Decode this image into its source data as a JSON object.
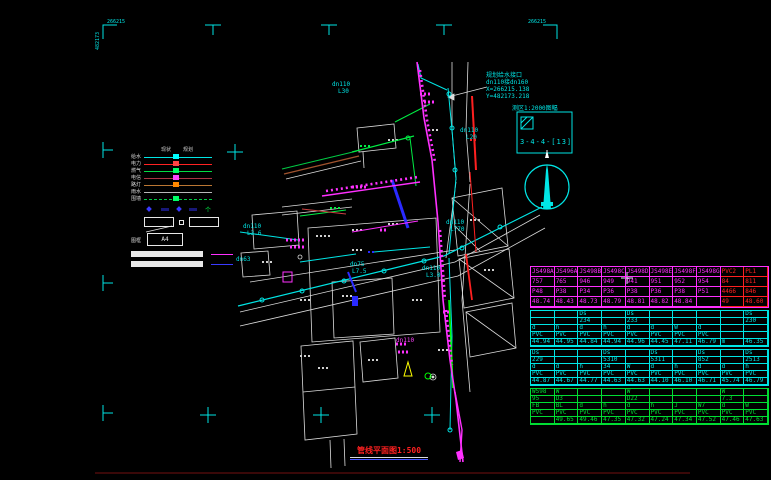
{
  "frame": {
    "corner_label_top_left": "266215",
    "corner_label_side": "482173",
    "corner_label_top_right": "266215"
  },
  "legend": {
    "header": [
      "现状",
      "规划"
    ],
    "lines": [
      {
        "label": "给水",
        "color": "#00e5e5",
        "marker": "#00ffff",
        "style": "solid"
      },
      {
        "label": "电力",
        "color": "#ff2222",
        "marker": "#ff4444",
        "style": "solid"
      },
      {
        "label": "燃气",
        "color": "#00dd44",
        "marker": "#00ff66",
        "style": "solid"
      },
      {
        "label": "电信",
        "color": "#aa3344",
        "marker": "#ff44ff",
        "style": "solid"
      },
      {
        "label": "路灯",
        "color": "#bb7733",
        "marker": "#ff8800",
        "style": "solid"
      },
      {
        "label": "雨水",
        "color": "#b8b8b8",
        "marker": "",
        "style": "solid"
      },
      {
        "label": "围墙",
        "color": "#00cc44",
        "marker": "#00ff66",
        "style": "dashed"
      }
    ],
    "box_label": "图框",
    "a4_label": "A4"
  },
  "annotation": {
    "lines": [
      "规划给水接口",
      "dn110接dn160",
      "X=266215.138",
      "Y=482173.218"
    ]
  },
  "index_box": {
    "header": "测区1:2000图幅",
    "label": "3-4-4-[13]"
  },
  "map_labels": [
    {
      "text": "dn110",
      "x": 332,
      "y": 82
    },
    {
      "text": "L30",
      "x": 338,
      "y": 89
    },
    {
      "text": "dn110",
      "x": 460,
      "y": 128
    },
    {
      "text": "L20",
      "x": 466,
      "y": 135
    },
    {
      "text": "dn110",
      "x": 243,
      "y": 224
    },
    {
      "text": "L3.6",
      "x": 247,
      "y": 231
    },
    {
      "text": "dn110",
      "x": 446,
      "y": 220
    },
    {
      "text": "L770",
      "x": 450,
      "y": 227
    },
    {
      "text": "dn75",
      "x": 350,
      "y": 262
    },
    {
      "text": "L7.5",
      "x": 352,
      "y": 269
    },
    {
      "text": "dn110",
      "x": 422,
      "y": 266
    },
    {
      "text": "L3.0",
      "x": 426,
      "y": 273
    },
    {
      "text": "dn63",
      "x": 236,
      "y": 257
    },
    {
      "text": "dn110",
      "x": 396,
      "y": 338,
      "color": "#ff40ff"
    }
  ],
  "title": {
    "text": "管线平面图1:500"
  },
  "table": {
    "bands": [
      {
        "color": "#ff30ff",
        "alt_color": "#ff2020",
        "alt_from": 8,
        "row_h": 10,
        "rows": [
          [
            "JS498A",
            "JS496A",
            "JS498B",
            "JS498C",
            "JS498D",
            "JS498E",
            "JS498F",
            "JS498G",
            "PVC2",
            "PL1"
          ],
          [
            "757",
            "765",
            "946",
            "949",
            "941",
            "951",
            "952",
            "954",
            "84",
            "811"
          ],
          [
            "P48",
            "P38",
            "P34",
            "P36",
            "P38",
            "P36",
            "P38",
            "P51",
            "4466",
            "846"
          ],
          [
            "48.74",
            "48.43",
            "48.73",
            "48.79",
            "48.81",
            "48.82",
            "48.84",
            "",
            "49",
            "48.60"
          ]
        ]
      },
      {
        "color": "#00e5e5",
        "row_h": 7,
        "rows": [
          [
            "",
            "",
            "Ds",
            "",
            "Ds",
            "",
            "",
            "",
            "",
            "Ds"
          ],
          [
            "",
            "",
            "234",
            "",
            "233",
            "",
            "",
            "",
            "",
            "230"
          ],
          [
            "d",
            "h",
            "d",
            "h",
            "d",
            "d",
            "W",
            "d",
            "",
            ""
          ],
          [
            "PVC",
            "PVC",
            "PVC",
            "PVC",
            "PVC",
            "PVC",
            "PVC",
            "PVC",
            "",
            ""
          ],
          [
            "44.94",
            "44.95",
            "44.84",
            "44.94",
            "44.96",
            "44.45",
            "47.11",
            "46.79",
            "m",
            "46.35"
          ]
        ]
      },
      {
        "color": "#00e5e5",
        "row_h": 7,
        "rows": [
          [
            "Ds",
            "",
            "",
            "Ds",
            "",
            "Ds",
            "",
            "Ds",
            "",
            "Ds"
          ],
          [
            "229",
            "",
            "",
            "5310",
            "",
            "5311",
            "",
            "852",
            "",
            "2513"
          ],
          [
            "d",
            "d",
            "h",
            "34",
            "W",
            "d",
            "h",
            "d",
            "d",
            "h"
          ],
          [
            "PVC",
            "PVC",
            "PVC",
            "PVC",
            "PVC",
            "PVC",
            "PVC",
            "PVC",
            "PVC",
            "PVC"
          ],
          [
            "44.87",
            "44.67",
            "44.77",
            "44.63",
            "44.63",
            "44.10",
            "46.10",
            "46.71",
            "45.74",
            "46.79"
          ]
        ]
      },
      {
        "color": "#00dd33",
        "row_h": 7,
        "rows": [
          [
            "WS98",
            "W",
            "",
            "",
            "W",
            "",
            "",
            "",
            "W",
            ""
          ],
          [
            "95",
            "D3",
            "",
            "",
            "D22",
            "",
            "",
            "",
            "7.3",
            ""
          ],
          [
            "FB",
            "BL",
            "d",
            "h",
            "d",
            "h",
            "J",
            "W7",
            "d",
            "W"
          ],
          [
            "PVC",
            "PVC",
            "PVC",
            "PVC",
            "PVC",
            "PVC",
            "PVC",
            "PVC",
            "PVC",
            "PVC"
          ],
          [
            "",
            "49.65",
            "49.46",
            "47.35",
            "47.32",
            "47.24",
            "47.34",
            "47.52",
            "47.46",
            "47.63"
          ]
        ]
      }
    ]
  }
}
